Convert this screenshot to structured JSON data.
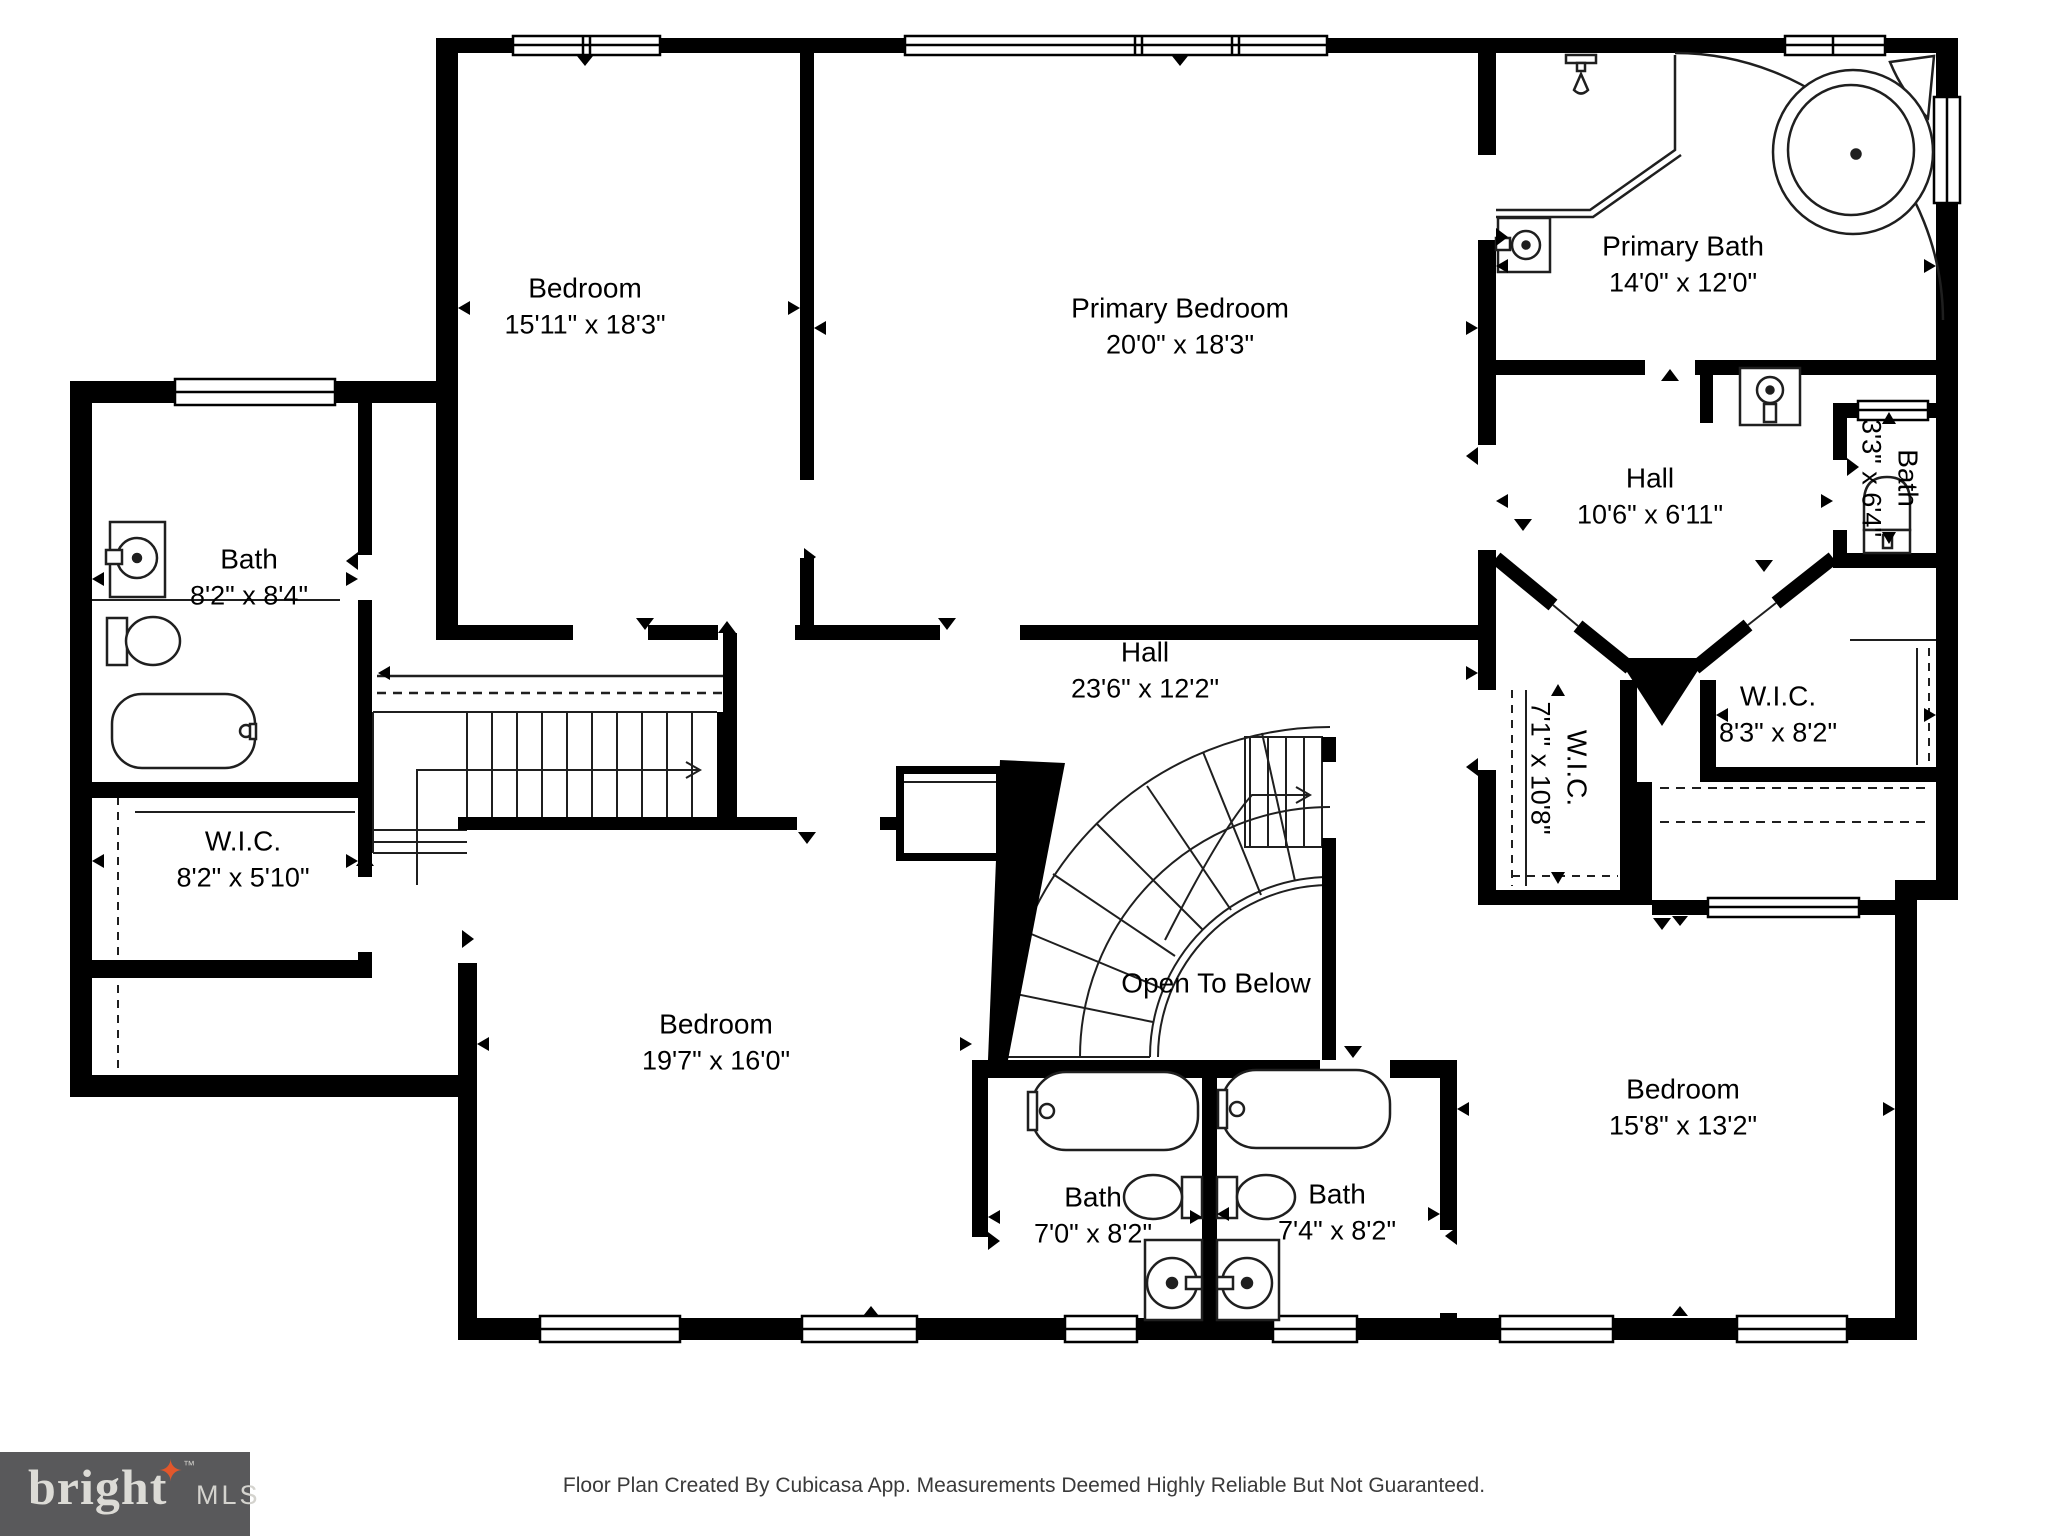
{
  "plan": {
    "rooms": [
      {
        "id": "bedroom-top-left",
        "name": "Bedroom",
        "dims": "15'11\" x 18'3\"",
        "x": 585,
        "y": 307,
        "rotated": false
      },
      {
        "id": "primary-bedroom",
        "name": "Primary Bedroom",
        "dims": "20'0\" x 18'3\"",
        "x": 1180,
        "y": 327,
        "rotated": false
      },
      {
        "id": "primary-bath",
        "name": "Primary Bath",
        "dims": "14'0\" x 12'0\"",
        "x": 1683,
        "y": 265,
        "rotated": false
      },
      {
        "id": "bath-top-right",
        "name": "Bath",
        "dims": "3'3\" x 6'4\"",
        "x": 1889,
        "y": 478,
        "rotated": true
      },
      {
        "id": "hall-primary",
        "name": "Hall",
        "dims": "10'6\" x 6'11\"",
        "x": 1650,
        "y": 497,
        "rotated": false
      },
      {
        "id": "wic-primary",
        "name": "W.I.C.",
        "dims": "7'1\" x 10'8\"",
        "x": 1558,
        "y": 768,
        "rotated": true
      },
      {
        "id": "wic-right",
        "name": "W.I.C.",
        "dims": "8'3\" x 8'2\"",
        "x": 1778,
        "y": 715,
        "rotated": false
      },
      {
        "id": "bath-left",
        "name": "Bath",
        "dims": "8'2\" x 8'4\"",
        "x": 249,
        "y": 578,
        "rotated": false
      },
      {
        "id": "wic-left",
        "name": "W.I.C.",
        "dims": "8'2\" x 5'10\"",
        "x": 243,
        "y": 860,
        "rotated": false
      },
      {
        "id": "hall-main",
        "name": "Hall",
        "dims": "23'6\" x 12'2\"",
        "x": 1145,
        "y": 671,
        "rotated": false
      },
      {
        "id": "bedroom-bottom-left",
        "name": "Bedroom",
        "dims": "19'7\" x 16'0\"",
        "x": 716,
        "y": 1043,
        "rotated": false
      },
      {
        "id": "bath-center-left",
        "name": "Bath",
        "dims": "7'0\" x 8'2\"",
        "x": 1093,
        "y": 1216,
        "rotated": false
      },
      {
        "id": "bath-center-right",
        "name": "Bath",
        "dims": "7'4\" x 8'2\"",
        "x": 1337,
        "y": 1213,
        "rotated": false
      },
      {
        "id": "bedroom-bottom-right",
        "name": "Bedroom",
        "dims": "15'8\" x 13'2\"",
        "x": 1683,
        "y": 1108,
        "rotated": false
      },
      {
        "id": "open-to-below",
        "name": "Open To Below",
        "dims": "",
        "x": 1216,
        "y": 984,
        "rotated": false
      }
    ]
  },
  "footer": {
    "text": "Floor Plan Created By Cubicasa App. Measurements Deemed Highly Reliable But Not Guaranteed."
  },
  "logo": {
    "brand": "bright",
    "tm": "™",
    "suffix": "MLS",
    "star": "✦"
  },
  "colors": {
    "walls": "#000000",
    "background": "#ffffff",
    "label_text": "#3f3f3f",
    "logo_bg": "#59595b",
    "logo_text": "#dcdbd6",
    "logo_star": "#e2572b"
  }
}
